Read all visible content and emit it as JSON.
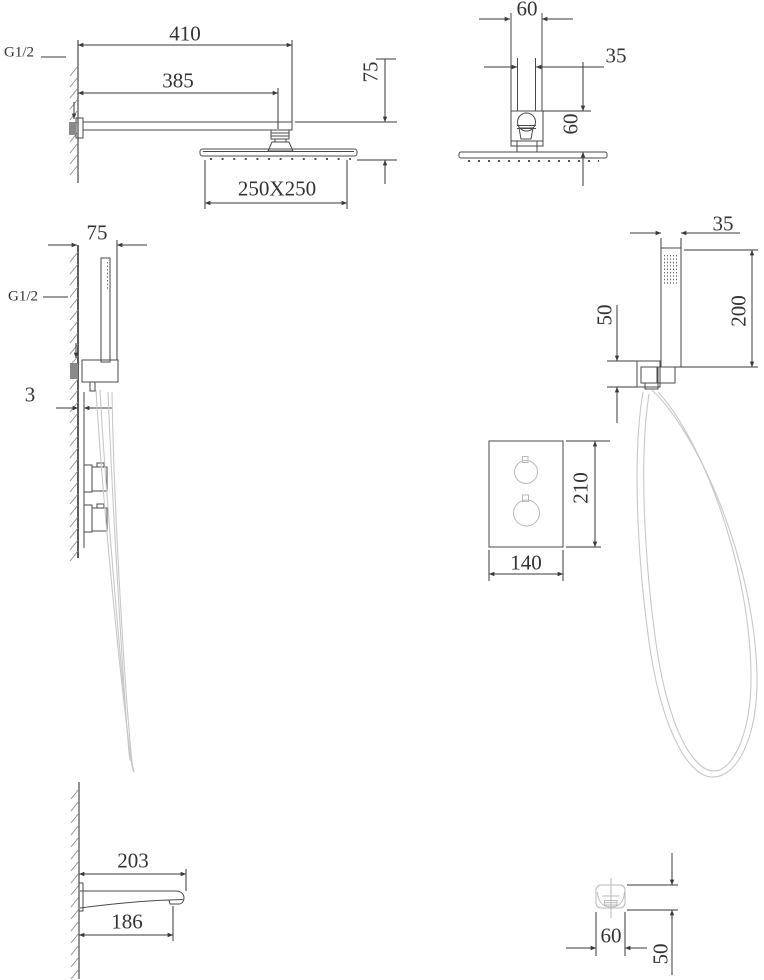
{
  "drawing_title": "shower-set-dimension-drawing",
  "colors": {
    "line": "#3a3a3a",
    "light_line": "#c8c8c8",
    "background": "#ffffff"
  },
  "views": {
    "rain_shower_side": {
      "arm_length": "410",
      "arm_reach": "385",
      "head_drop": "75",
      "head_size": "250X250",
      "inlet_thread": "G1/2"
    },
    "rain_shower_front": {
      "flange_width": "60",
      "pipe_width": "35",
      "fitting_height": "60"
    },
    "hand_shower_side": {
      "bracket_depth": "75",
      "inlet_thread": "G1/2",
      "plate_gap": "3"
    },
    "hand_shower_front": {
      "handset_width": "35",
      "handset_length": "200",
      "bracket_size": "50"
    },
    "control_plate": {
      "plate_width": "140",
      "plate_height": "210"
    },
    "spout_side": {
      "spout_length": "203",
      "outlet_reach": "186"
    },
    "spout_front": {
      "spout_width": "60",
      "spout_height": "50"
    }
  }
}
